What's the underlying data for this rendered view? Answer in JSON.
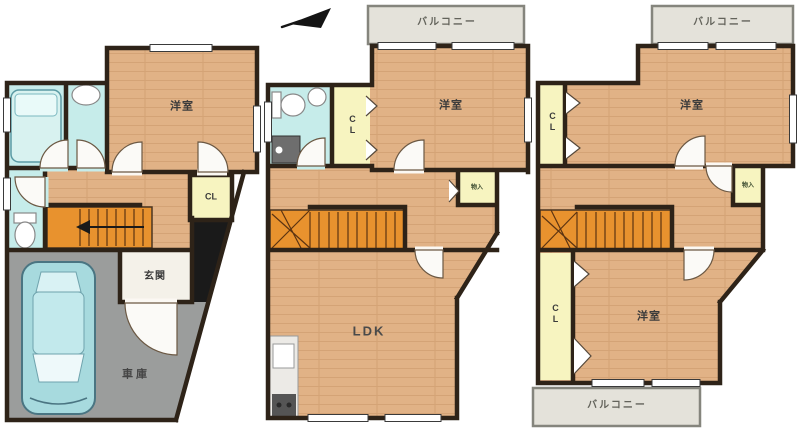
{
  "floors": {
    "f1": {
      "room1": "洋室",
      "closet": "CL",
      "entrance": "玄関",
      "garage": "車庫"
    },
    "f2": {
      "balcony": "バルコニー",
      "room1": "洋室",
      "closet": "CL",
      "storage": "物入",
      "living": "LDK"
    },
    "f3": {
      "balcony_top": "バルコニー",
      "room_top": "洋室",
      "closet_top": "CL",
      "storage": "物入",
      "room_bottom": "洋室",
      "closet_bottom": "CL",
      "balcony_bottom": "バルコニー"
    }
  },
  "palette": {
    "wall": "#2e2318",
    "wood_floor": "#e1b286",
    "wet_area": "#c6ecea",
    "closet": "#f7f4c0",
    "stairs": "#e8922e",
    "garage": "#9b9d9c",
    "balcony": "#e4e2da",
    "car": "#a7dade",
    "void": "#1a1a1a"
  }
}
